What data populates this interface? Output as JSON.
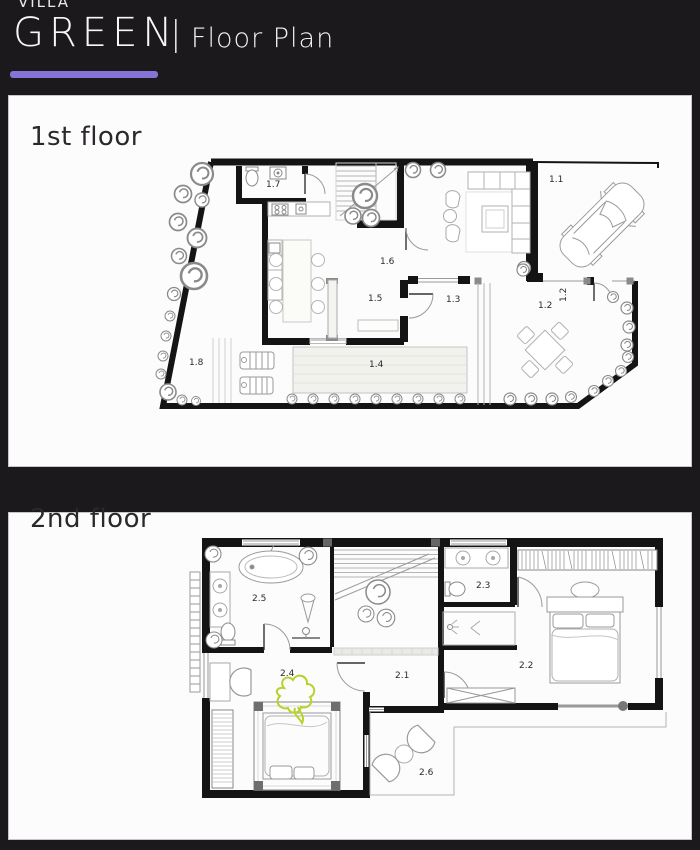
{
  "header": {
    "brand_top": "VILLA",
    "brand_main": "GREEN",
    "separator": "|",
    "subtitle": "Floor Plan"
  },
  "colors": {
    "accent_underline": "#8474d8",
    "highlight_green": "#b6d32b",
    "background": "#1b191b",
    "panel": "#fcfcfc",
    "wall": "#141414"
  },
  "floor1": {
    "title": "1st floor",
    "rooms": [
      {
        "label": "1.1"
      },
      {
        "label": "1.2"
      },
      {
        "label": "1.3"
      },
      {
        "label": "1.4"
      },
      {
        "label": "1.5"
      },
      {
        "label": "1.6"
      },
      {
        "label": "1.7"
      },
      {
        "label": "1.8"
      }
    ]
  },
  "floor2": {
    "title": "2nd floor",
    "rooms": [
      {
        "label": "2.1"
      },
      {
        "label": "2.2"
      },
      {
        "label": "2.3"
      },
      {
        "label": "2.4"
      },
      {
        "label": "2.5"
      },
      {
        "label": "2.6"
      }
    ]
  }
}
